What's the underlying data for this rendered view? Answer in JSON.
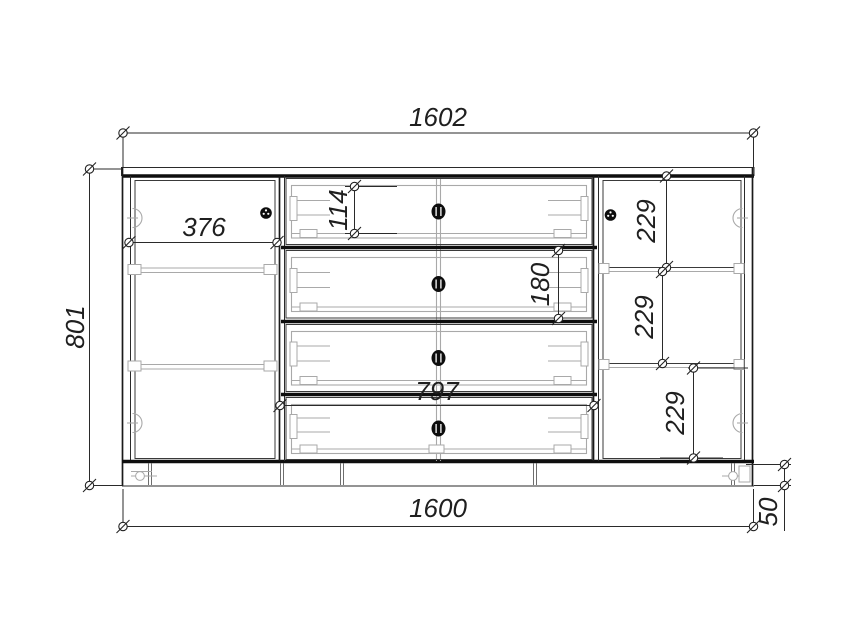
{
  "drawing": {
    "colors": {
      "background": "#ffffff",
      "main_line": "#1a1a1a",
      "detail_line": "#a9a9a9",
      "dimension_text": "#1f1f1f"
    },
    "dimensions": {
      "overall_width": "1602",
      "overall_height": "801",
      "left_door_width": "376",
      "top_drawer_box_height": "114",
      "drawer_front_height": "180",
      "right_compartment_top": "229",
      "right_compartment_middle": "229",
      "right_compartment_bottom": "229",
      "drawer_opening_width": "797",
      "carcass_width": "1600",
      "plinth_height": "50"
    }
  }
}
